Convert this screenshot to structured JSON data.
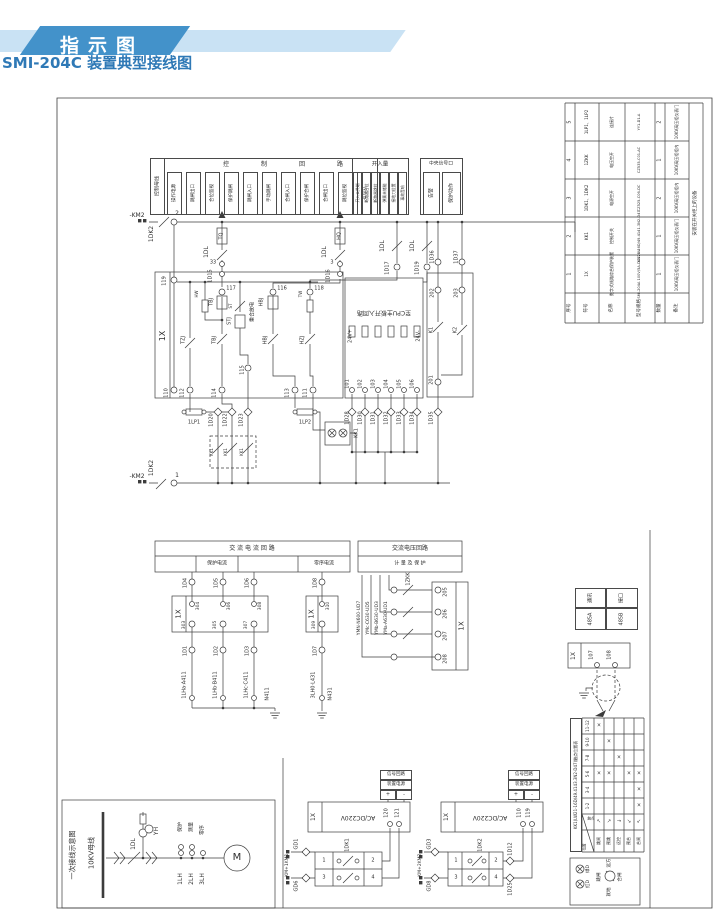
{
  "banner": {
    "label": "指示图"
  },
  "title": "SMI-204C 装置典型接线图",
  "colors": {
    "banner_dark": "#4392ca",
    "banner_light": "#c9e2f4",
    "title_blue": "#2f79b6",
    "line": "#3c3c3c"
  },
  "strip": {
    "bus_label": "控制母线",
    "groups": [
      "控",
      "制",
      "回",
      "路"
    ],
    "functions": [
      "操作电源",
      "跳闸出口",
      "合位监视",
      "保护跳闸",
      "跳闸入口",
      "手动跳闸",
      "合闸入口",
      "保护合闸",
      "合闸出口",
      "跳位监视",
      "合位灯"
    ],
    "kairu": {
      "title": "开入量",
      "items": [
        "开入公共端",
        "断路器合位",
        "断路器跳位",
        "弹簧未储能",
        "接地刀位置",
        "事故音响"
      ]
    },
    "central": {
      "title": "中央信号口",
      "items": [
        "告警",
        "保护动作"
      ]
    }
  },
  "bom_table": {
    "columns": [
      "序号",
      "符号",
      "名称",
      "型号规格",
      "数量",
      "备注"
    ],
    "rows": [
      [
        "5",
        "1LP1、1LP2",
        "连接片",
        "YY1-D1-A",
        "2",
        "10KV高压柜仪表门"
      ],
      [
        "4",
        "1ZKK",
        "电压空开",
        "CZ535-C01-AC",
        "1",
        "10KV高压柜柜内"
      ],
      [
        "3",
        "1DK1、1DK2",
        "电源空开",
        "CZ525-C06-DC",
        "2",
        "10KV高压柜柜内"
      ],
      [
        "2",
        "KK1",
        "控制开关",
        "LW21-16D/49.4141.3N2-D47",
        "1",
        "10KV高压柜仪表门"
      ],
      [
        "1",
        "1X",
        "数字式线路综合保护装置",
        "SMI-204A 100V/5A-DC220V",
        "1",
        "10KV高压柜仪表门"
      ]
    ],
    "note": "安装在开关柜上的设备"
  },
  "contact_table": {
    "title": "KK1(LW21-16D/49.4143.3N2-D47)触点位置表",
    "pairs": [
      "11-12",
      "9-10",
      "7-8",
      "5-6",
      "3-4",
      "1-2"
    ],
    "positions": [
      "跳闸",
      "预跳",
      "远控",
      "预合",
      "合闸"
    ],
    "arrows": [
      "↖",
      "↗",
      "→",
      "↘",
      "↙"
    ],
    "diag1": "触点",
    "diag2": "位置",
    "mark": "×",
    "marks": [
      [
        1,
        0,
        0,
        0,
        0
      ],
      [
        0,
        1,
        0,
        0,
        0
      ],
      [
        0,
        0,
        1,
        0,
        0
      ],
      [
        1,
        1,
        0,
        1,
        1
      ],
      [
        0,
        0,
        0,
        0,
        1
      ],
      [
        0,
        0,
        0,
        0,
        1
      ]
    ]
  },
  "comm_box": {
    "cells": [
      "通讯",
      "接口",
      "485A",
      "485B"
    ]
  },
  "power_tables": {
    "rows": [
      "信号回路",
      "装置电源"
    ],
    "plus": "+",
    "minus": "-"
  },
  "labels": [
    [
      "-KM2",
      137,
      216,
      0,
      6
    ],
    [
      "1DK2",
      152,
      234,
      1,
      6
    ],
    [
      "2",
      177,
      214,
      0,
      6
    ],
    [
      "TQ",
      222,
      236,
      1,
      5
    ],
    [
      "HQ",
      340,
      236,
      1,
      5
    ],
    [
      "1DL",
      207,
      252,
      1,
      6
    ],
    [
      "1DL",
      325,
      252,
      1,
      6
    ],
    [
      "1DL",
      383,
      246,
      1,
      6
    ],
    [
      "1DL",
      413,
      246,
      1,
      6
    ],
    [
      "33",
      213,
      263,
      0,
      5
    ],
    [
      "1D15",
      211,
      276,
      1,
      5
    ],
    [
      "3",
      332,
      263,
      0,
      5
    ],
    [
      "1D16",
      329,
      276,
      1,
      5
    ],
    [
      "1D17",
      388,
      268,
      1,
      5
    ],
    [
      "1D19",
      418,
      268,
      1,
      5
    ],
    [
      "1X",
      163,
      336,
      1,
      8
    ],
    [
      "119",
      165,
      281,
      1,
      5
    ],
    [
      "117",
      231,
      289,
      0,
      5
    ],
    [
      "116",
      282,
      289,
      0,
      5
    ],
    [
      "118",
      319,
      289,
      0,
      5
    ],
    [
      "TBJ",
      212,
      302,
      1,
      5
    ],
    [
      "HBJ",
      262,
      302,
      1,
      5
    ],
    [
      "HW",
      197,
      294,
      1,
      4
    ],
    [
      "ST",
      231,
      306,
      1,
      4
    ],
    [
      "TW",
      301,
      294,
      1,
      4
    ],
    [
      "重合放电",
      253,
      312,
      1,
      5
    ],
    [
      "TZJ",
      184,
      340,
      1,
      5
    ],
    [
      "TBJ",
      215,
      340,
      1,
      5
    ],
    [
      "STJ",
      230,
      321,
      1,
      5
    ],
    [
      "HBJ",
      266,
      340,
      1,
      5
    ],
    [
      "HZJ",
      303,
      340,
      1,
      5
    ],
    [
      "115",
      243,
      370,
      1,
      5
    ],
    [
      "110",
      167,
      393,
      1,
      5
    ],
    [
      "112",
      183,
      393,
      1,
      5
    ],
    [
      "114",
      215,
      393,
      1,
      5
    ],
    [
      "113",
      288,
      393,
      1,
      5
    ],
    [
      "111",
      306,
      393,
      1,
      5
    ],
    [
      "1LP1",
      194,
      423,
      0,
      5
    ],
    [
      "1LP2",
      305,
      423,
      0,
      5
    ],
    [
      "1D20",
      212,
      420,
      1,
      5
    ],
    [
      "1D22",
      226,
      420,
      1,
      5
    ],
    [
      "1D23",
      242,
      420,
      1,
      5
    ],
    [
      "KK1",
      212,
      452,
      1,
      4
    ],
    [
      "KK1",
      226,
      452,
      1,
      4
    ],
    [
      "KK1",
      242,
      452,
      1,
      4
    ],
    [
      "KK1",
      357,
      433,
      1,
      5
    ],
    [
      "至CPU主板开入回路",
      384,
      312,
      2,
      6
    ],
    [
      "24V+",
      351,
      336,
      1,
      5
    ],
    [
      "24V-",
      419,
      336,
      1,
      5
    ],
    [
      "101",
      348,
      384,
      1,
      5
    ],
    [
      "102",
      361,
      384,
      1,
      5
    ],
    [
      "103",
      374,
      384,
      1,
      5
    ],
    [
      "104",
      387,
      384,
      1,
      5
    ],
    [
      "105",
      400,
      384,
      1,
      5
    ],
    [
      "106",
      413,
      384,
      1,
      5
    ],
    [
      "1D28",
      348,
      418,
      1,
      5
    ],
    [
      "1D30",
      361,
      418,
      1,
      5
    ],
    [
      "1D31",
      374,
      418,
      1,
      5
    ],
    [
      "1D32",
      387,
      418,
      1,
      5
    ],
    [
      "1D33",
      400,
      418,
      1,
      5
    ],
    [
      "1D34",
      413,
      418,
      1,
      5
    ],
    [
      "1D36",
      433,
      257,
      1,
      5
    ],
    [
      "1D37",
      457,
      257,
      1,
      5
    ],
    [
      "202",
      433,
      293,
      1,
      5
    ],
    [
      "203",
      457,
      293,
      1,
      5
    ],
    [
      "K1",
      432,
      330,
      1,
      5
    ],
    [
      "K2",
      456,
      330,
      1,
      5
    ],
    [
      "201",
      432,
      380,
      1,
      5
    ],
    [
      "1D35",
      432,
      418,
      1,
      5
    ],
    [
      "交 流 电 流 回 路",
      252,
      549,
      0,
      6
    ],
    [
      "保护电流",
      217,
      564,
      0,
      5
    ],
    [
      "零序电流",
      324,
      564,
      0,
      5
    ],
    [
      "交流电压回路",
      410,
      549,
      0,
      6
    ],
    [
      "计 量 及 保 护",
      410,
      564,
      0,
      5
    ],
    [
      "1D4",
      186,
      583,
      1,
      5
    ],
    [
      "1D5",
      217,
      583,
      1,
      5
    ],
    [
      "1D6",
      248,
      583,
      1,
      5
    ],
    [
      "1D8",
      316,
      583,
      1,
      5
    ],
    [
      "1X",
      179,
      614,
      1,
      7
    ],
    [
      "1X",
      312,
      614,
      1,
      7
    ],
    [
      "304",
      199,
      606,
      1,
      4.5
    ],
    [
      "303",
      185,
      625,
      1,
      4.5
    ],
    [
      "306",
      230,
      606,
      1,
      4.5
    ],
    [
      "305",
      216,
      625,
      1,
      4.5
    ],
    [
      "308",
      261,
      606,
      1,
      4.5
    ],
    [
      "307",
      247,
      625,
      1,
      4.5
    ],
    [
      "310",
      329,
      606,
      1,
      4.5
    ],
    [
      "309",
      315,
      625,
      1,
      4.5
    ],
    [
      "1D1",
      186,
      651,
      1,
      5
    ],
    [
      "1D2",
      217,
      651,
      1,
      5
    ],
    [
      "1D3",
      248,
      651,
      1,
      5
    ],
    [
      "1D7",
      316,
      651,
      1,
      5
    ],
    [
      "1LHa·A411",
      185,
      685,
      1,
      5
    ],
    [
      "1LHb·B411",
      216,
      685,
      1,
      5
    ],
    [
      "1LHc·C411",
      247,
      685,
      1,
      5
    ],
    [
      "N411",
      268,
      694,
      1,
      5
    ],
    [
      "3LH0·L431",
      314,
      685,
      1,
      5
    ],
    [
      "N431",
      331,
      694,
      1,
      5
    ],
    [
      "YMN·N600·UD7",
      360,
      618,
      1,
      4.5
    ],
    [
      "YMc·C630·UD5",
      369,
      618,
      1,
      4.5
    ],
    [
      "YMb·B630·UD3",
      378,
      618,
      1,
      4.5
    ],
    [
      "YMa·A630·UD1",
      387,
      618,
      1,
      4.5
    ],
    [
      "1ZKK",
      409,
      579,
      1,
      5
    ],
    [
      "205",
      446,
      592,
      1,
      5
    ],
    [
      "206",
      446,
      614,
      1,
      5
    ],
    [
      "207",
      446,
      636,
      1,
      5
    ],
    [
      "208",
      446,
      659,
      1,
      5
    ],
    [
      "1X",
      462,
      626,
      1,
      7
    ],
    [
      "1X",
      574,
      656,
      1,
      6
    ],
    [
      "107",
      592,
      655,
      1,
      5
    ],
    [
      "108",
      610,
      655,
      1,
      5
    ],
    [
      "-KM+1KM1",
      288,
      866,
      1,
      4.5
    ],
    [
      "GD1",
      297,
      844,
      1,
      5
    ],
    [
      "GD6",
      297,
      886,
      1,
      5
    ],
    [
      "1DK1",
      348,
      845,
      1,
      5
    ],
    [
      "1",
      324,
      861,
      0,
      5
    ],
    [
      "2",
      373,
      861,
      0,
      5
    ],
    [
      "3",
      324,
      878,
      0,
      5
    ],
    [
      "4",
      373,
      878,
      0,
      5
    ],
    [
      "1X",
      314,
      817,
      1,
      6
    ],
    [
      "AC/DC220V",
      358,
      817,
      2,
      6
    ],
    [
      "120",
      387,
      813,
      1,
      5
    ],
    [
      "121",
      398,
      813,
      1,
      5
    ],
    [
      "-KM+2KM2",
      421,
      866,
      1,
      4.5
    ],
    [
      "GD3",
      430,
      844,
      1,
      5
    ],
    [
      "GD8",
      430,
      886,
      1,
      5
    ],
    [
      "1DK2",
      481,
      845,
      1,
      5
    ],
    [
      "1",
      456,
      861,
      0,
      5
    ],
    [
      "2",
      496,
      861,
      0,
      5
    ],
    [
      "3",
      456,
      878,
      0,
      5
    ],
    [
      "4",
      496,
      878,
      0,
      5
    ],
    [
      "1X",
      447,
      817,
      1,
      6
    ],
    [
      "AC/DC220V",
      490,
      817,
      2,
      6
    ],
    [
      "110",
      520,
      813,
      1,
      5
    ],
    [
      "119",
      529,
      813,
      1,
      5
    ],
    [
      "1D12",
      511,
      849,
      1,
      5
    ],
    [
      "1D25",
      511,
      889,
      1,
      5
    ],
    [
      "一次接线示意图",
      73,
      855,
      1,
      7
    ],
    [
      "10KV母线",
      92,
      853,
      1,
      7
    ],
    [
      "1DL",
      134,
      844,
      1,
      6
    ],
    [
      "YH",
      157,
      831,
      1,
      6
    ],
    [
      "保护",
      181,
      827,
      1,
      5
    ],
    [
      "测量",
      192,
      827,
      1,
      5
    ],
    [
      "零序",
      203,
      830,
      1,
      5
    ],
    [
      "1LH",
      181,
      879,
      1,
      6
    ],
    [
      "2LH",
      192,
      879,
      1,
      6
    ],
    [
      "3LH",
      203,
      879,
      1,
      6
    ],
    [
      "M",
      237,
      858,
      0,
      10
    ],
    [
      "1",
      177,
      476,
      0,
      6
    ],
    [
      "-KM2",
      137,
      477,
      0,
      6
    ],
    [
      "1DK2",
      152,
      468,
      1,
      6
    ],
    [
      "绿D",
      589,
      869,
      1,
      4.5
    ],
    [
      "红D",
      589,
      884,
      1,
      4.5
    ],
    [
      "远方",
      610,
      863,
      1,
      4.5
    ],
    [
      "跳闸",
      600,
      877,
      1,
      4.5
    ],
    [
      "合闸",
      621,
      877,
      1,
      4.5
    ],
    [
      "就地",
      610,
      892,
      1,
      4.5
    ]
  ]
}
